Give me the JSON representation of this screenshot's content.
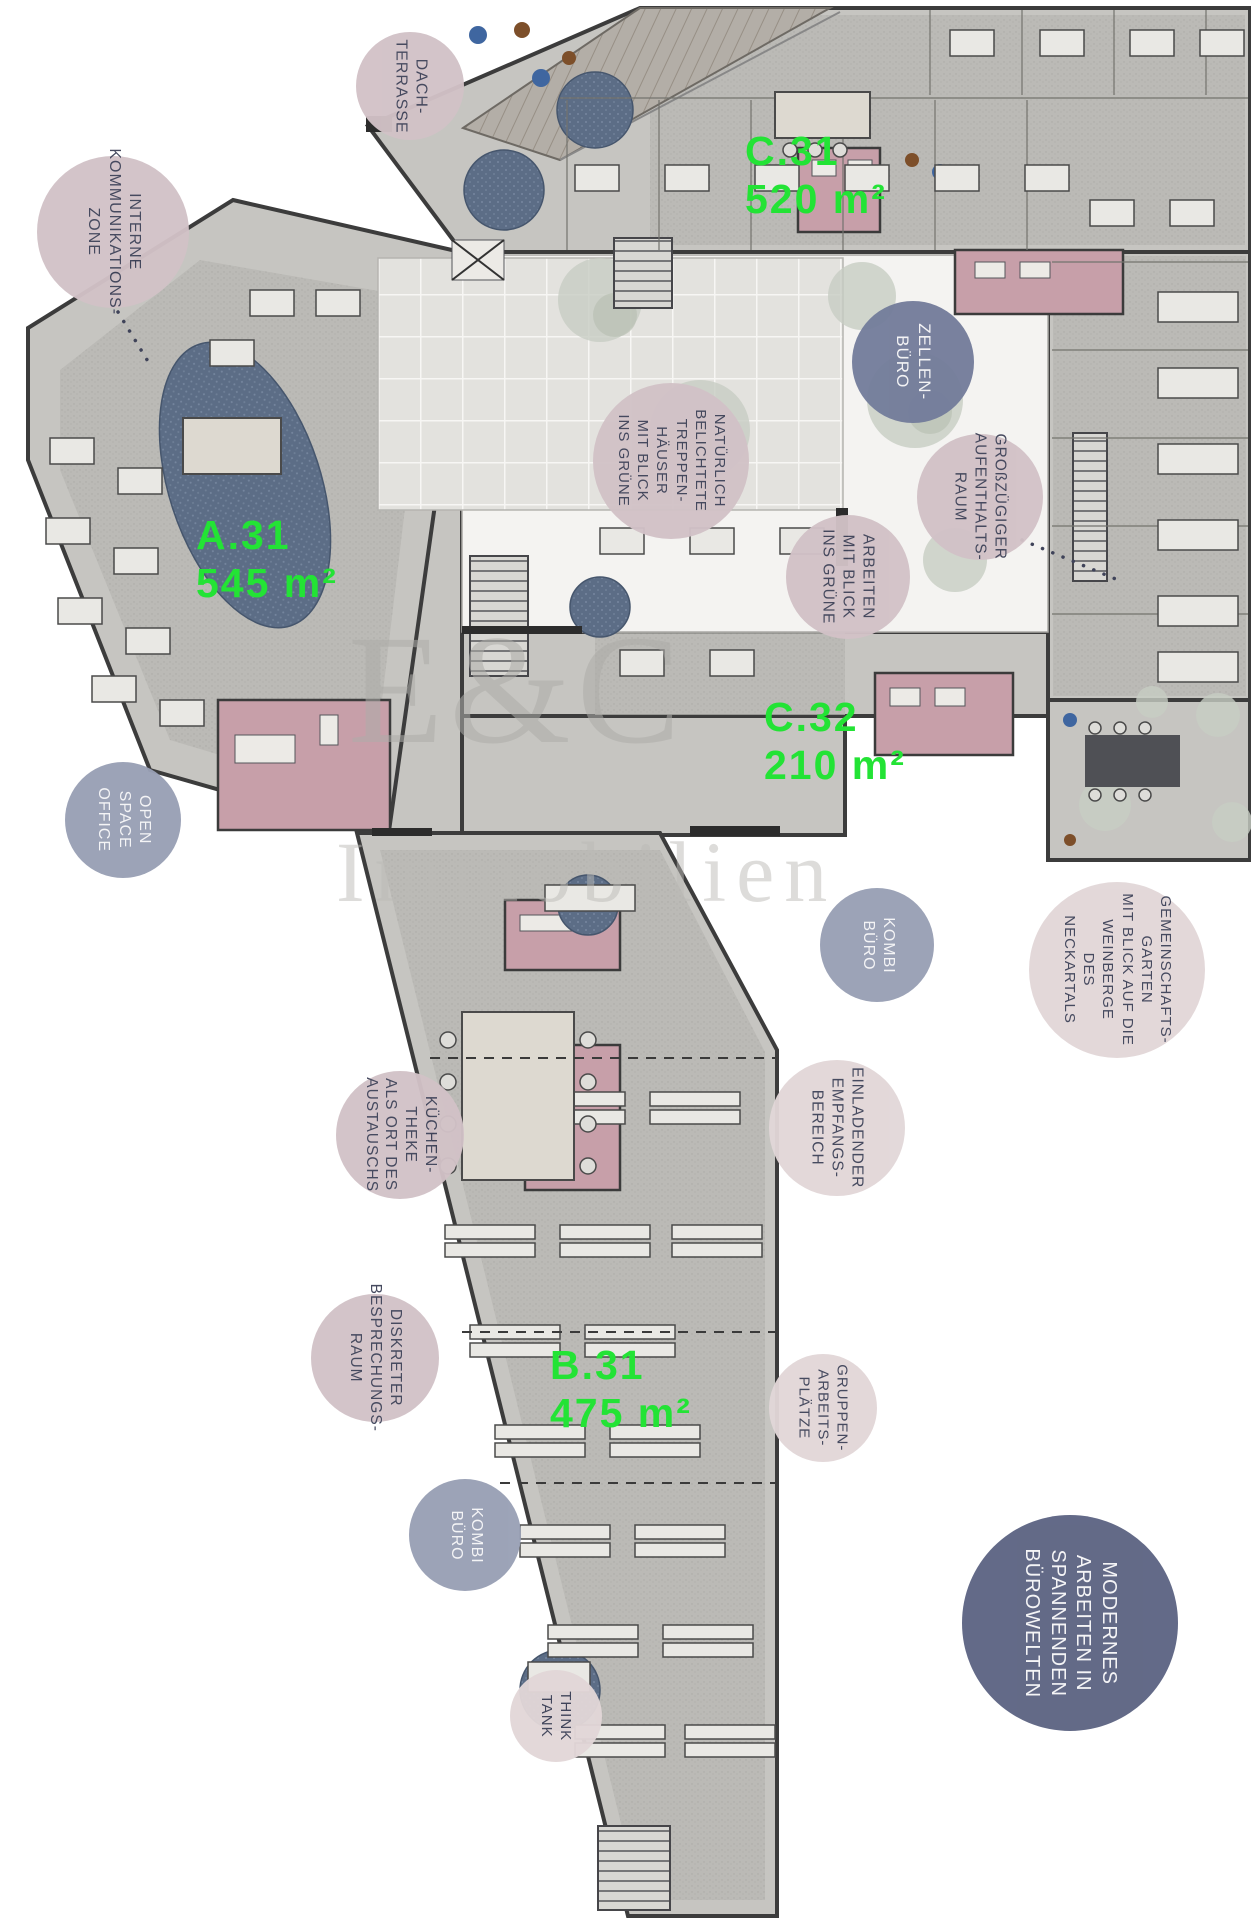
{
  "watermark": {
    "line1": "E&C",
    "line2": "Immobilien"
  },
  "colors": {
    "green": "#23e335",
    "ink": "#3f4359",
    "pink": "#d2c2c7",
    "pink_light": "#e2d7d8",
    "blue": "#99a0b5",
    "blue_dark": "#747d9b",
    "navy": "#5d6483",
    "text_on_blue": "#f4f4f6"
  },
  "area_labels": [
    {
      "id": "a31",
      "x": 196,
      "y": 512,
      "line1": "A.31",
      "line2": "545 m²"
    },
    {
      "id": "b31",
      "x": 550,
      "y": 1342,
      "line1": "B.31",
      "line2": "475 m²"
    },
    {
      "id": "c31",
      "x": 745,
      "y": 128,
      "line1": "C.31",
      "line2": "520 m²"
    },
    {
      "id": "c32",
      "x": 764,
      "y": 694,
      "line1": "C.32",
      "line2": "210 m²"
    }
  ],
  "callouts": [
    {
      "id": "dach-terrasse",
      "x": 410,
      "y": 86,
      "r": 54,
      "variant": "pink",
      "fs": 16,
      "lines": [
        "DACH-",
        "TERRASSE"
      ]
    },
    {
      "id": "interne-kommunikationszone",
      "x": 113,
      "y": 232,
      "r": 76,
      "variant": "pink",
      "fs": 16,
      "lines": [
        "INTERNE",
        "KOMMUNIKATIONS-",
        "ZONE"
      ]
    },
    {
      "id": "zellen-buero",
      "x": 913,
      "y": 362,
      "r": 61,
      "variant": "blue_dark",
      "fs": 17,
      "lines": [
        "ZELLEN-",
        "BÜRO"
      ]
    },
    {
      "id": "treppenhaeuser",
      "x": 671,
      "y": 461,
      "r": 78,
      "variant": "pink",
      "fs": 15,
      "lines": [
        "NATÜRLICH",
        "BELICHTETE",
        "TREPPEN-",
        "HÄUSER",
        "MIT BLICK",
        "INS GRÜNE"
      ]
    },
    {
      "id": "aufenthaltsraum",
      "x": 980,
      "y": 497,
      "r": 63,
      "variant": "pink",
      "fs": 15.5,
      "lines": [
        "GROßZÜGIGER",
        "AUFENTHALTS-",
        "RAUM"
      ]
    },
    {
      "id": "arbeiten-mit-blick",
      "x": 848,
      "y": 577,
      "r": 62,
      "variant": "pink",
      "fs": 15.5,
      "lines": [
        "ARBEITEN",
        "MIT BLICK",
        "INS GRÜNE"
      ]
    },
    {
      "id": "open-space-office",
      "x": 123,
      "y": 820,
      "r": 58,
      "variant": "blue",
      "fs": 16,
      "lines": [
        "OPEN",
        "SPACE",
        "OFFICE"
      ]
    },
    {
      "id": "kombi-buero-1",
      "x": 877,
      "y": 945,
      "r": 57,
      "variant": "blue",
      "fs": 16,
      "lines": [
        "KOMBI",
        "BÜRO"
      ]
    },
    {
      "id": "gemeinschaftsgarten",
      "x": 1117,
      "y": 970,
      "r": 88,
      "variant": "pink_light",
      "fs": 15,
      "lines": [
        "GEMEINSCHAFTS-",
        "GARTEN",
        "MIT BLICK AUF DIE",
        "WEINBERGE",
        "DES",
        "NECKARTALS"
      ]
    },
    {
      "id": "kuechentheke",
      "x": 400,
      "y": 1135,
      "r": 64,
      "variant": "pink",
      "fs": 15.5,
      "lines": [
        "KÜCHEN-",
        "THEKE",
        "ALS ORT DES",
        "AUSTAUSCHS"
      ]
    },
    {
      "id": "empfangsbereich",
      "x": 837,
      "y": 1128,
      "r": 68,
      "variant": "pink_light",
      "fs": 15.5,
      "lines": [
        "EINLADENDER",
        "EMPFANGS-",
        "BEREICH"
      ]
    },
    {
      "id": "besprechungsraum",
      "x": 375,
      "y": 1358,
      "r": 64,
      "variant": "pink",
      "fs": 15.5,
      "lines": [
        "DISKRETER",
        "BESPRECHUNGS-",
        "RAUM"
      ]
    },
    {
      "id": "gruppenarbeitsplaetze",
      "x": 823,
      "y": 1408,
      "r": 54,
      "variant": "pink_light",
      "fs": 15,
      "lines": [
        "GRUPPEN-",
        "ARBEITS-",
        "PLÄTZE"
      ]
    },
    {
      "id": "kombi-buero-2",
      "x": 465,
      "y": 1535,
      "r": 56,
      "variant": "blue",
      "fs": 16,
      "lines": [
        "KOMBI",
        "BÜRO"
      ]
    },
    {
      "id": "think-tank",
      "x": 556,
      "y": 1716,
      "r": 46,
      "variant": "pink_light",
      "fs": 15,
      "lines": [
        "THINK",
        "TANK"
      ]
    },
    {
      "id": "modernes-arbeiten",
      "x": 1070,
      "y": 1623,
      "r": 108,
      "variant": "navy",
      "fs": 20,
      "lines": [
        "MODERNES",
        "ARBEITEN IN",
        "SPANNENDEN",
        "BÜROWELTEN"
      ]
    }
  ]
}
